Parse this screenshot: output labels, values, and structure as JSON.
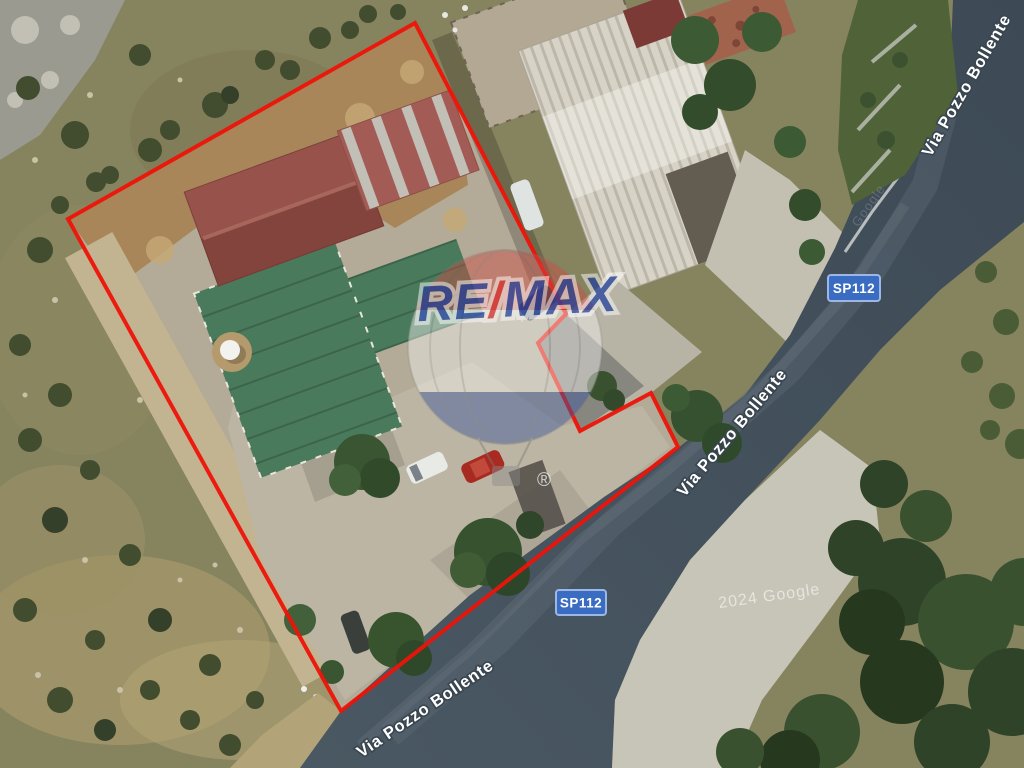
{
  "map_overlay": {
    "road_name": "Via Pozzo Bollente",
    "route_badge": "SP112",
    "copyright": "2024 Google",
    "faint_watermark": "Google",
    "badge_bg": "#3a6cc2",
    "badge_border": "#9cb7e6",
    "label_text_color": "#ffffff"
  },
  "parcel": {
    "boundary_color": "#ee1308"
  },
  "brand_watermark": {
    "name": "RE/MAX",
    "part_re": "RE",
    "part_slash": "/",
    "part_max": "MAX",
    "registered_mark": "®",
    "text_blue": "#1d3d9e",
    "slash_red": "#d92b27"
  }
}
